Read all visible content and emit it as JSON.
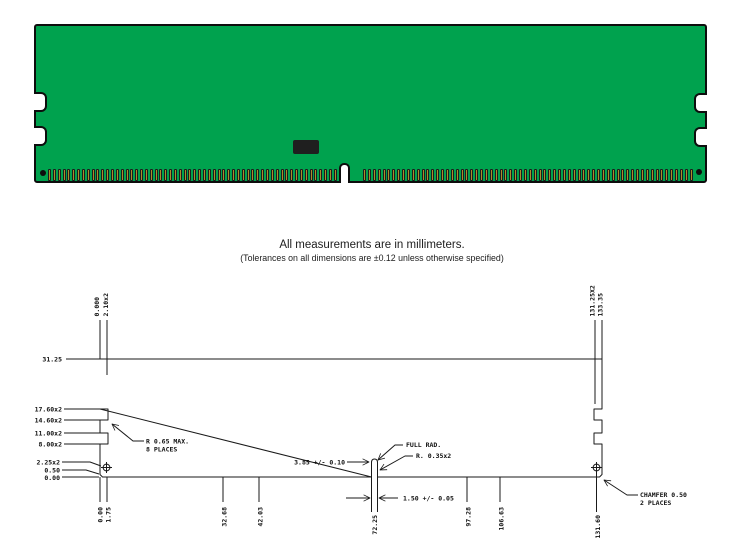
{
  "pcb": {
    "board_color": "#00a24e",
    "border_color": "#0d0d0d",
    "pin_color": "#a88d2a",
    "pin_border_color": "#1c1c1c",
    "chip_color": "#1f1f1f",
    "left_pin_count": 60,
    "right_pin_count": 68
  },
  "caption": {
    "line1": "All measurements are in millimeters.",
    "line2": "(Tolerances on all dimensions are ±0.12 unless otherwise specified)"
  },
  "drawing": {
    "top_labels": [
      "0.000",
      "2.10x2",
      "131.25X2",
      "133.35"
    ],
    "left_labels": [
      "31.25",
      "17.60x2",
      "14.60x2",
      "11.00x2",
      "8.00x2",
      "2.25x2",
      "0.50",
      "0.00"
    ],
    "bottom_labels": [
      "0.00",
      "1.75",
      "32.68",
      "42.03",
      "72.25",
      "97.28",
      "106.63",
      "131.60"
    ],
    "notes": {
      "edge_notch_radius_1": "R 0.65 MAX.",
      "edge_notch_radius_2": "8 PLACES",
      "key_depth": "3.85 +/- 0.10",
      "full_rad": "FULL RAD.",
      "key_radius": "R. 0.35x2",
      "key_width": "1.50 +/- 0.05",
      "chamfer_1": "CHAMFER 0.50",
      "chamfer_2": "2 PLACES"
    }
  }
}
